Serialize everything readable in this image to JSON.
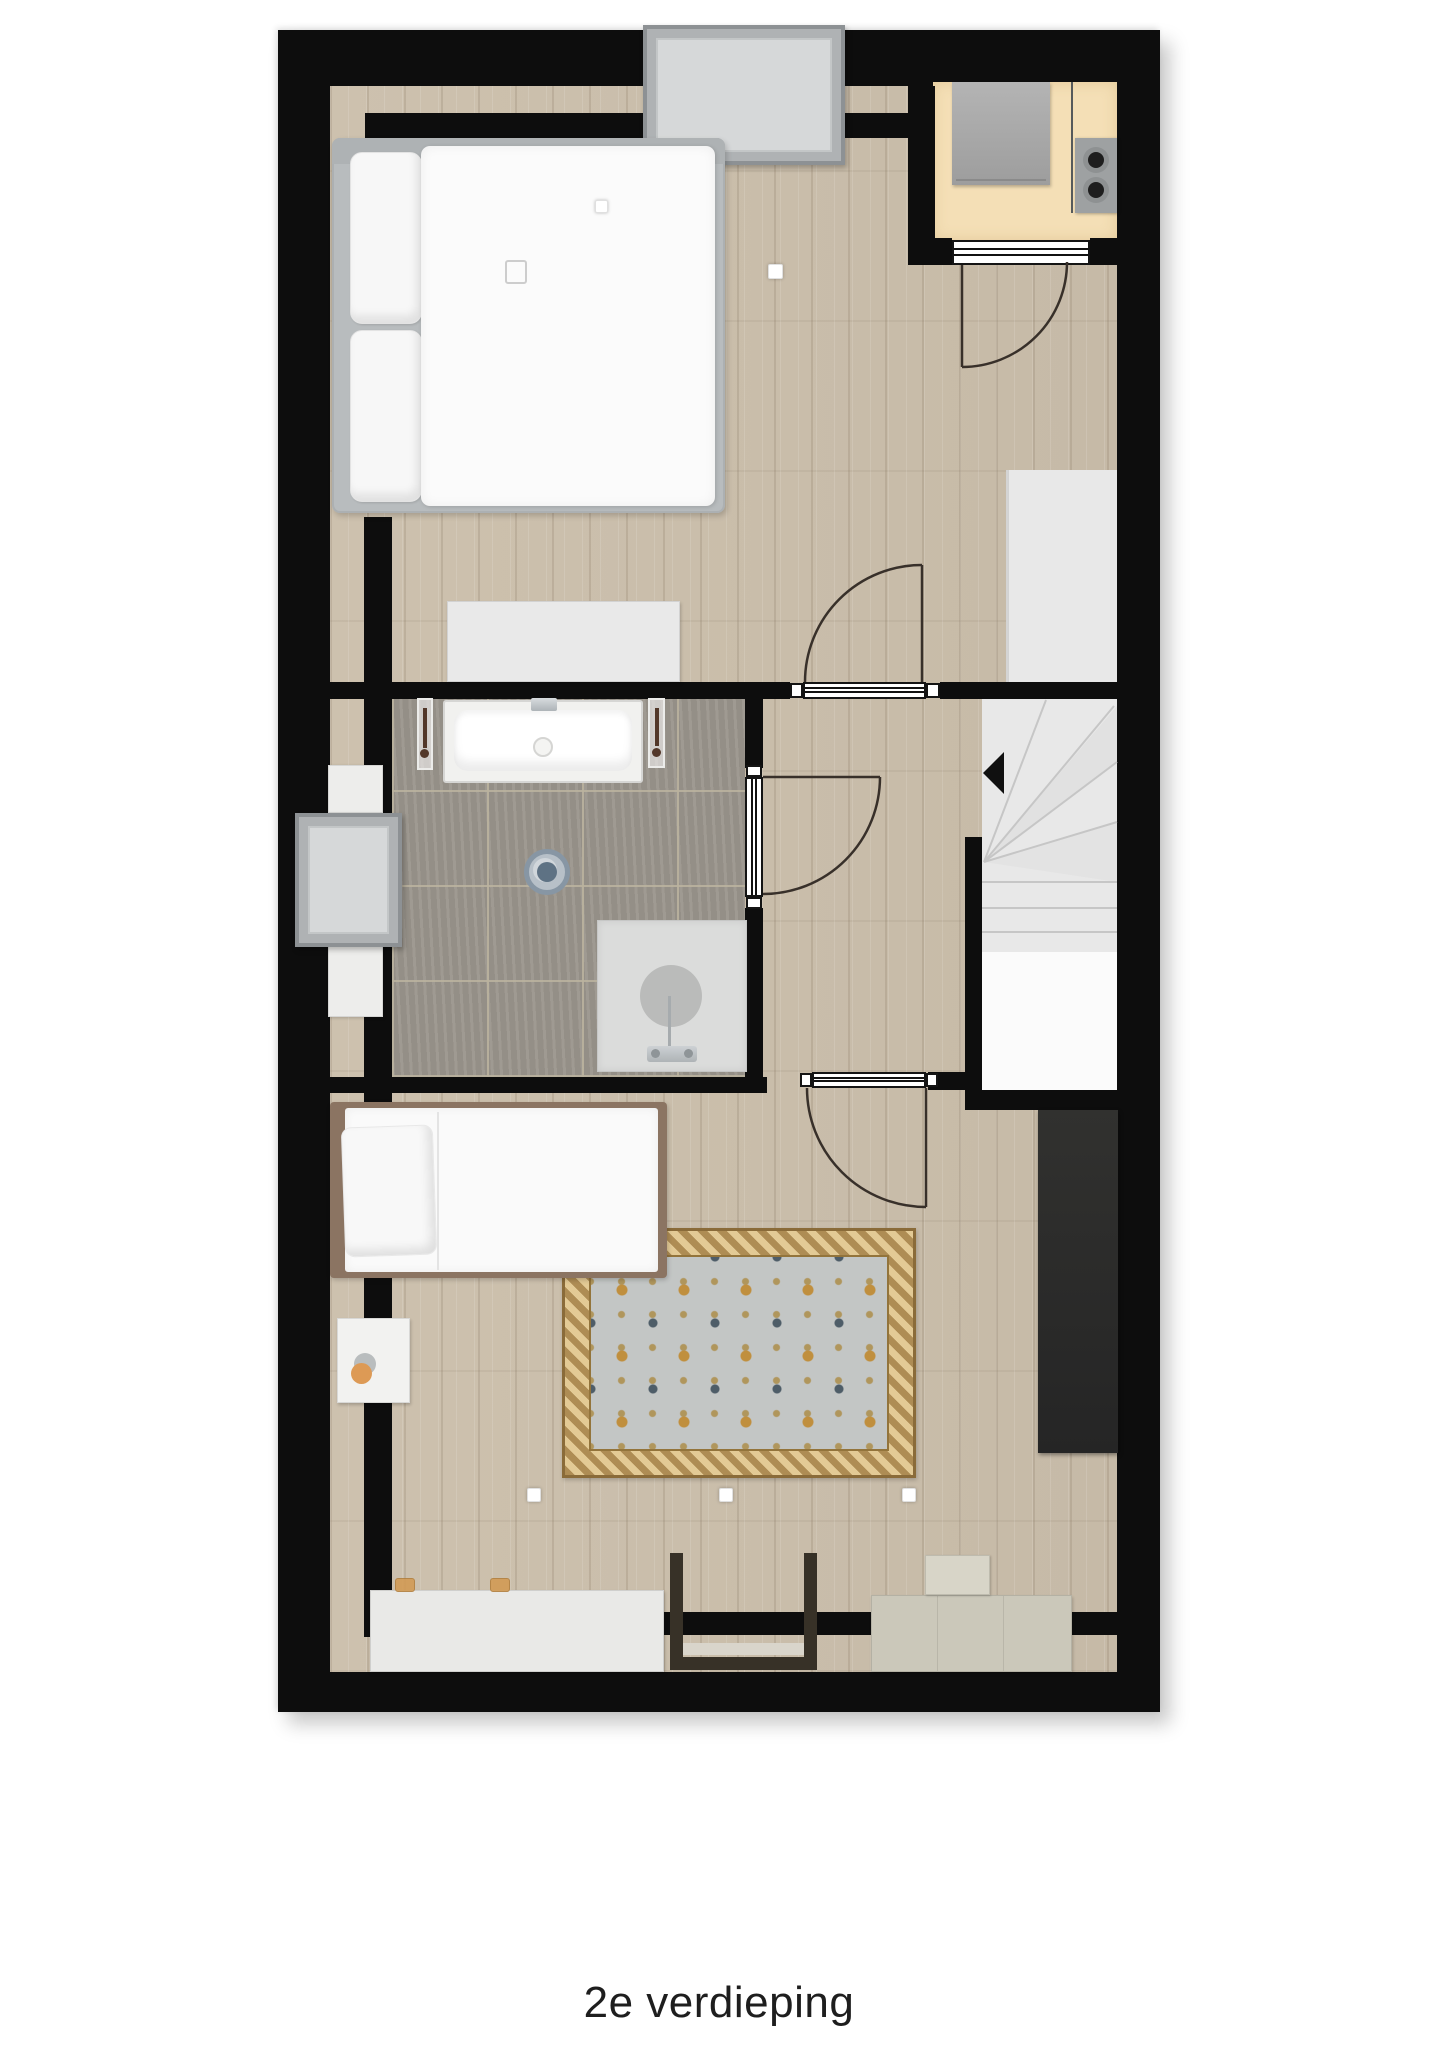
{
  "page": {
    "background": "#ffffff",
    "caption": "2e verdieping"
  },
  "palette": {
    "wall": "#0d0d0d",
    "wood": "#cbbfac",
    "tile": "#9a958c",
    "closet_floor": "#f4dfb6",
    "stair_grey": "#e8e8e8",
    "rug_border_gold": "#c99d52",
    "rug_field": "#c3c6c5",
    "wardrobe_dark": "#2b2b2b",
    "bed2_frame_brown": "#8b7462",
    "door_arc": "#38302a"
  },
  "plan": {
    "x": 278,
    "y": 30,
    "w": 882,
    "h": 1682
  },
  "rects": [
    {
      "name": "wood-floor",
      "cls": "f-wood",
      "x": 330,
      "y": 86,
      "w": 787,
      "h": 1586
    },
    {
      "name": "bathroom-floor",
      "cls": "f-tile",
      "x": 392,
      "y": 698,
      "w": 353,
      "h": 379
    },
    {
      "name": "closet-floor",
      "cls": "f-beige",
      "x": 933,
      "y": 82,
      "w": 184,
      "h": 158
    },
    {
      "name": "stair-void",
      "cls": "f-grey edge-l",
      "x": 1007,
      "y": 470,
      "w": 110,
      "h": 212
    },
    {
      "name": "stairwell-floor",
      "cls": "f-grey",
      "x": 982,
      "y": 698,
      "w": 135,
      "h": 392
    },
    {
      "name": "stairwell-lower-floor",
      "cls": "f-white",
      "x": 982,
      "y": 952,
      "w": 135,
      "h": 138
    },
    {
      "name": "knee-wall-top-left",
      "cls": "wall",
      "x": 365,
      "y": 113,
      "w": 278,
      "h": 25
    },
    {
      "name": "knee-wall-top-right",
      "cls": "wall",
      "x": 845,
      "y": 113,
      "w": 63,
      "h": 25
    },
    {
      "name": "knee-wall-left",
      "cls": "wall",
      "x": 364,
      "y": 517,
      "w": 28,
      "h": 1120
    },
    {
      "name": "wall-bed1-bath-left",
      "cls": "wall",
      "x": 330,
      "y": 682,
      "w": 460,
      "h": 17
    },
    {
      "name": "wall-bed1-bath-right",
      "cls": "wall",
      "x": 940,
      "y": 682,
      "w": 177,
      "h": 17
    },
    {
      "name": "wall-bath-hall-upper",
      "cls": "wall",
      "x": 745,
      "y": 698,
      "w": 18,
      "h": 70
    },
    {
      "name": "wall-bath-hall-lower",
      "cls": "wall",
      "x": 745,
      "y": 908,
      "w": 18,
      "h": 169
    },
    {
      "name": "wall-bath-bottom",
      "cls": "wall",
      "x": 330,
      "y": 1077,
      "w": 437,
      "h": 16
    },
    {
      "name": "wall-bed2-door-right",
      "cls": "wall",
      "x": 928,
      "y": 1072,
      "w": 54,
      "h": 18
    },
    {
      "name": "wall-stair-left",
      "cls": "wall",
      "x": 965,
      "y": 837,
      "w": 17,
      "h": 273
    },
    {
      "name": "wall-stair-bottom",
      "cls": "wall",
      "x": 965,
      "y": 1090,
      "w": 195,
      "h": 20
    },
    {
      "name": "wall-closet-left",
      "cls": "wall",
      "x": 908,
      "y": 86,
      "w": 27,
      "h": 179
    },
    {
      "name": "wall-closet-stub-left",
      "cls": "wall",
      "x": 935,
      "y": 238,
      "w": 17,
      "h": 27
    },
    {
      "name": "wall-closet-stub-right",
      "cls": "wall",
      "x": 1090,
      "y": 238,
      "w": 27,
      "h": 27
    },
    {
      "name": "knee-wall-bottom",
      "cls": "wall",
      "x": 392,
      "y": 1612,
      "w": 736,
      "h": 23
    },
    {
      "name": "dormer-window-top",
      "cls": "dormer",
      "x": 643,
      "y": 25,
      "w": 202,
      "h": 140
    },
    {
      "name": "bed-1-frame",
      "cls": "bedframe1",
      "x": 332,
      "y": 138,
      "w": 393,
      "h": 375
    },
    {
      "name": "bed-1-pillow-upper",
      "cls": "pillow",
      "x": 350,
      "y": 152,
      "w": 72,
      "h": 172
    },
    {
      "name": "bed-1-pillow-lower",
      "cls": "pillow",
      "x": 350,
      "y": 330,
      "w": 72,
      "h": 172
    },
    {
      "name": "bed-1-duvet",
      "cls": "duvet",
      "x": 421,
      "y": 146,
      "w": 294,
      "h": 360
    },
    {
      "name": "dresser-bedroom-1",
      "cls": "dresser",
      "x": 447,
      "y": 601,
      "w": 233,
      "h": 81
    },
    {
      "name": "downlight-bedroom-1",
      "cls": "downlight",
      "x": 595,
      "y": 200,
      "w": 13,
      "h": 13
    },
    {
      "name": "downlight-landing",
      "cls": "downlight",
      "x": 768,
      "y": 264,
      "w": 15,
      "h": 15
    },
    {
      "name": "washing-machine",
      "cls": "washer",
      "x": 952,
      "y": 82,
      "w": 98,
      "h": 103
    },
    {
      "name": "laundry-tap-panel",
      "cls": "apanel",
      "x": 1075,
      "y": 138,
      "w": 42,
      "h": 75
    },
    {
      "name": "closet-divider-line",
      "cls": "divline",
      "x": 1071,
      "y": 82,
      "w": 2,
      "h": 131
    },
    {
      "name": "closet-folding-door",
      "cls": "threshold-h",
      "x": 952,
      "y": 240,
      "w": 138,
      "h": 25
    },
    {
      "name": "bathtub",
      "cls": "tub",
      "x": 443,
      "y": 700,
      "w": 200,
      "h": 83
    },
    {
      "name": "bathtub-faucet",
      "cls": "faucet",
      "x": 531,
      "y": 698,
      "w": 26,
      "h": 13
    },
    {
      "name": "bathtub-drain",
      "cls": "tdrain",
      "x": 533,
      "y": 737,
      "w": 20,
      "h": 20
    },
    {
      "name": "towel-rail-left",
      "cls": "towel",
      "x": 417,
      "y": 698,
      "w": 16,
      "h": 72
    },
    {
      "name": "towel-rail-right",
      "cls": "towel",
      "x": 648,
      "y": 698,
      "w": 17,
      "h": 70
    },
    {
      "name": "floor-drain",
      "cls": "drain",
      "x": 524,
      "y": 849,
      "w": 46,
      "h": 46
    },
    {
      "name": "shower-tray",
      "cls": "shower",
      "x": 597,
      "y": 920,
      "w": 150,
      "h": 152
    },
    {
      "name": "shower-pole",
      "cls": "pole",
      "x": 668,
      "y": 996,
      "w": 3,
      "h": 56
    },
    {
      "name": "shower-mixer",
      "cls": "mixer",
      "x": 647,
      "y": 1046,
      "w": 50,
      "h": 16
    },
    {
      "name": "bath-cabinet-upper",
      "cls": "cab",
      "x": 328,
      "y": 765,
      "w": 55,
      "h": 48
    },
    {
      "name": "bath-cabinet-lower",
      "cls": "cab",
      "x": 328,
      "y": 945,
      "w": 55,
      "h": 72
    },
    {
      "name": "dormer-window-left",
      "cls": "dormer",
      "x": 295,
      "y": 813,
      "w": 107,
      "h": 134
    },
    {
      "name": "threshold-bedroom-1-door",
      "cls": "threshold-h",
      "x": 803,
      "y": 682,
      "w": 123,
      "h": 17
    },
    {
      "name": "jamb-bedroom-1-left",
      "cls": "jamb",
      "x": 790,
      "y": 683,
      "w": 13,
      "h": 15
    },
    {
      "name": "jamb-bedroom-1-right",
      "cls": "jamb",
      "x": 926,
      "y": 683,
      "w": 14,
      "h": 15
    },
    {
      "name": "threshold-bathroom-door",
      "cls": "threshold-v",
      "x": 745,
      "y": 777,
      "w": 18,
      "h": 120
    },
    {
      "name": "jamb-bathroom-top",
      "cls": "jamb",
      "x": 746,
      "y": 765,
      "w": 16,
      "h": 12
    },
    {
      "name": "jamb-bathroom-bottom",
      "cls": "jamb",
      "x": 746,
      "y": 897,
      "w": 16,
      "h": 12
    },
    {
      "name": "threshold-bedroom-2-door",
      "cls": "threshold-h",
      "x": 812,
      "y": 1072,
      "w": 114,
      "h": 16
    },
    {
      "name": "jamb-bedroom-2-left",
      "cls": "jamb",
      "x": 800,
      "y": 1073,
      "w": 12,
      "h": 14
    },
    {
      "name": "jamb-bedroom-2-right",
      "cls": "jamb",
      "x": 926,
      "y": 1073,
      "w": 12,
      "h": 14
    },
    {
      "name": "wardrobe-dark",
      "cls": "wardrobe",
      "x": 1038,
      "y": 1110,
      "w": 80,
      "h": 343
    },
    {
      "name": "area-rug",
      "cls": "rug",
      "x": 562,
      "y": 1228,
      "w": 354,
      "h": 250
    },
    {
      "name": "bed-2-frame",
      "cls": "bedframe2",
      "x": 330,
      "y": 1102,
      "w": 337,
      "h": 176
    },
    {
      "name": "bed-2-pillow",
      "cls": "pillow2",
      "x": 343,
      "y": 1126,
      "w": 92,
      "h": 130
    },
    {
      "name": "bed-2-duvet-fold",
      "cls": "foldline",
      "x": 437,
      "y": 1112,
      "w": 2,
      "h": 158
    },
    {
      "name": "nightstand",
      "cls": "nightstand",
      "x": 337,
      "y": 1318,
      "w": 73,
      "h": 85
    },
    {
      "name": "downlight-bedroom-2-a",
      "cls": "downlight",
      "x": 527,
      "y": 1488,
      "w": 14,
      "h": 14
    },
    {
      "name": "downlight-bedroom-2-b",
      "cls": "downlight",
      "x": 719,
      "y": 1488,
      "w": 14,
      "h": 14
    },
    {
      "name": "downlight-bedroom-2-c",
      "cls": "downlight",
      "x": 902,
      "y": 1488,
      "w": 14,
      "h": 14
    },
    {
      "name": "desk-bedroom-2",
      "cls": "desk2",
      "x": 370,
      "y": 1590,
      "w": 294,
      "h": 82
    },
    {
      "name": "desk-glass-a",
      "cls": "glass",
      "x": 395,
      "y": 1578,
      "w": 20,
      "h": 14
    },
    {
      "name": "desk-glass-b",
      "cls": "glass",
      "x": 490,
      "y": 1578,
      "w": 20,
      "h": 14
    },
    {
      "name": "clothes-rack",
      "cls": "rack",
      "x": 670,
      "y": 1553,
      "w": 147,
      "h": 117
    },
    {
      "name": "dresser-bedroom-2",
      "cls": "dresser2",
      "x": 871,
      "y": 1595,
      "w": 201,
      "h": 77
    },
    {
      "name": "dresser-2-box",
      "cls": "dresser2top",
      "x": 925,
      "y": 1555,
      "w": 65,
      "h": 40
    }
  ],
  "vectors": [
    {
      "name": "stair-wedge-a",
      "d": "M 984 862 L 1117 706 L 1117 762 Z",
      "fill": "#e1e1e1",
      "stroke": "none",
      "w": 0
    },
    {
      "name": "stair-wedge-b",
      "d": "M 984 862 L 1117 822 L 1117 882 Z",
      "fill": "#e3e3e3",
      "stroke": "none",
      "w": 0
    },
    {
      "name": "stair-step-1",
      "d": "M 984 862 L 1046 700",
      "fill": "none",
      "stroke": "#c6c6c6",
      "w": 2
    },
    {
      "name": "stair-step-2",
      "d": "M 984 862 L 1114 706",
      "fill": "none",
      "stroke": "#c6c6c6",
      "w": 2
    },
    {
      "name": "stair-step-3",
      "d": "M 984 862 L 1117 762",
      "fill": "none",
      "stroke": "#c6c6c6",
      "w": 2
    },
    {
      "name": "stair-step-4",
      "d": "M 984 862 L 1117 822",
      "fill": "none",
      "stroke": "#c6c6c6",
      "w": 2
    },
    {
      "name": "stair-step-5",
      "d": "M 982 882 L 1117 882",
      "fill": "none",
      "stroke": "#c6c6c6",
      "w": 2
    },
    {
      "name": "stair-step-6",
      "d": "M 982 908 L 1117 908",
      "fill": "none",
      "stroke": "#c6c6c6",
      "w": 2
    },
    {
      "name": "stair-step-7",
      "d": "M 982 932 L 1117 932",
      "fill": "none",
      "stroke": "#c6c6c6",
      "w": 2
    },
    {
      "name": "stair-void-edge",
      "d": "M 1007 470 L 1007 682",
      "fill": "none",
      "stroke": "#d4d4d4",
      "w": 2
    },
    {
      "name": "door-leaf-bedroom-1",
      "d": "M 922 565 L 922 682",
      "fill": "none",
      "stroke": "#38302a",
      "w": 2.5
    },
    {
      "name": "door-arc-bedroom-1",
      "d": "M 805 682 A 117 117 0 0 1 922 565",
      "fill": "none",
      "stroke": "#38302a",
      "w": 2.5
    },
    {
      "name": "door-leaf-bathroom",
      "d": "M 763 777 L 880 777",
      "fill": "none",
      "stroke": "#38302a",
      "w": 2.5
    },
    {
      "name": "door-arc-bathroom",
      "d": "M 880 777 A 117 117 0 0 1 763 894",
      "fill": "none",
      "stroke": "#38302a",
      "w": 2.5
    },
    {
      "name": "door-leaf-bedroom-2",
      "d": "M 926 1088 L 926 1207",
      "fill": "none",
      "stroke": "#38302a",
      "w": 2.5
    },
    {
      "name": "door-arc-bedroom-2",
      "d": "M 926 1207 A 119 119 0 0 1 807 1088",
      "fill": "none",
      "stroke": "#38302a",
      "w": 2.5
    },
    {
      "name": "door-leaf-closet",
      "d": "M 962 265 L 962 367",
      "fill": "none",
      "stroke": "#38302a",
      "w": 2.5
    },
    {
      "name": "door-arc-closet",
      "d": "M 962 367 A 105 105 0 0 0 1067 262",
      "fill": "none",
      "stroke": "#38302a",
      "w": 2.5
    },
    {
      "name": "stair-direction-arrow",
      "d": "M 1004 752 L 1004 794 L 983 773 Z",
      "fill": "#101010",
      "stroke": "none",
      "w": 0
    }
  ],
  "caption": {
    "text": "2e verdieping",
    "x": 278,
    "y": 1978,
    "w": 882
  }
}
